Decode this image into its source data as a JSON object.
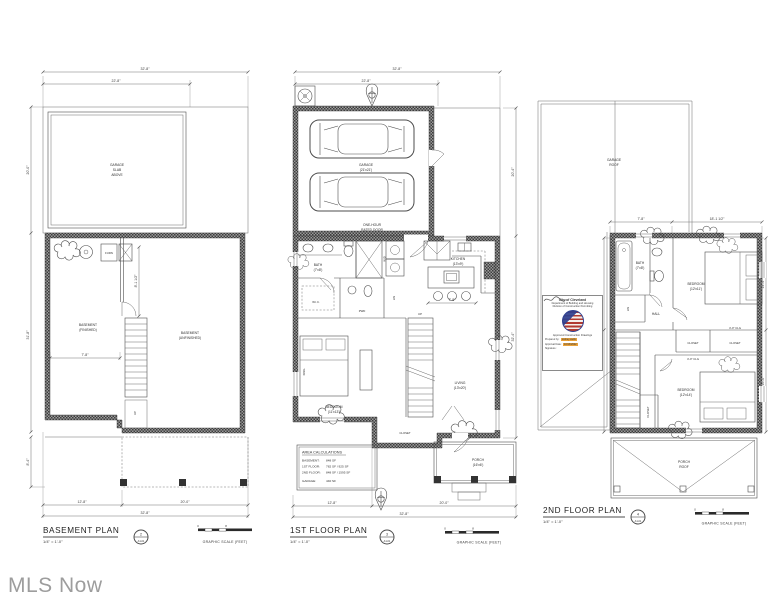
{
  "watermark": "MLS Now",
  "shared": {
    "graphic_scale": "GRAPHIC SCALE (FEET)",
    "scale_note": "1/4\" = 1'-0\"",
    "bar_zero": "0",
    "bar_eight": "8"
  },
  "basement": {
    "title": "BASEMENT PLAN",
    "ref_no": "2",
    "ref_sheet": "A1-01",
    "garage_slab": {
      "l1": "GARAGE",
      "l2": "SLAB",
      "l3": "ABOVE"
    },
    "room_left": {
      "l1": "BASEMENT",
      "l2": "(FINISHED)"
    },
    "room_right": {
      "l1": "BASEMENT",
      "l2": "(UNFINISHED)"
    },
    "furnace": "FURN",
    "stairs_up": "UP",
    "dims": {
      "top_total": "32'-8\"",
      "top_partial": "22'-8\"",
      "left_upper": "20'-0\"",
      "left_lower": "31'-8\"",
      "left_porch": "8'-4\"",
      "interior_width": "7'-8\"",
      "interior_height": "8'-1 1/2\"",
      "bottom_left": "12'-8\"",
      "bottom_right": "20'-0\"",
      "bottom_total": "32'-8\""
    }
  },
  "first": {
    "title": "1ST FLOOR PLAN",
    "ref_no": "3",
    "ref_sheet": "A1-01",
    "garage": {
      "l1": "GARAGE",
      "l2": "(21'x21')"
    },
    "rated_door": {
      "l1": "ONE-HOUR",
      "l2": "RATED DOOR"
    },
    "bath": {
      "l1": "BATH",
      "l2": "(7'x8')"
    },
    "wd": "W/D",
    "wic": "W.I.C.",
    "pwd": "PWD",
    "linen": "LIN",
    "kitchen": {
      "l1": "KITCHEN",
      "l2": "(13'x9')"
    },
    "living": {
      "l1": "LIVING",
      "l2": "(13'x20')"
    },
    "bedroom": {
      "l1": "BEDROOM",
      "l2": "(11'x13')"
    },
    "king": "KING",
    "closet": "CLOSET",
    "porch": {
      "l1": "PORCH",
      "l2": "(16'x6')"
    },
    "stairs_up": "UP",
    "area_calc": {
      "title": "AREA CALCULATIONS",
      "rows": [
        {
          "label": "BASEMENT:",
          "value": "848 SF"
        },
        {
          "label": "1ST FLOOR:",
          "value": "782 SF / 925 SF"
        },
        {
          "label": "2ND FLOOR:",
          "value": "848 SF / 1595 SF"
        },
        {
          "label": "GARAGE:",
          "value": "440 SF"
        }
      ]
    },
    "dims": {
      "top_total": "32'-8\"",
      "top_partial": "22'-8\"",
      "right_garage": "20'-4\"",
      "right_house": "32'-4\"",
      "kitchen_island": "7'-8\"",
      "bottom_left": "12'-8\"",
      "bottom_right": "20'-0\"",
      "bottom_total": "32'-8\""
    }
  },
  "second": {
    "title": "2ND FLOOR PLAN",
    "ref_no": "4",
    "ref_sheet": "A1-01",
    "garage_roof": {
      "l1": "GARAGE",
      "l2": "ROOF"
    },
    "bath": {
      "l1": "BATH",
      "l2": "(7'x8')"
    },
    "linen": "LIN",
    "hall": "HALL",
    "bedroom1": {
      "l1": "BEDROOM",
      "l2": "(12'x11')"
    },
    "bedroom2": {
      "l1": "BEDROOM",
      "l2": "(12'x14')"
    },
    "closet1": "CLOSET",
    "closet2": "CLOSET",
    "closet3": "CLOSET",
    "clg_note1": "4'-0\" CLG",
    "clg_note2": "4'-0\" CLG",
    "porch_roof": {
      "l1": "PORCH",
      "l2": "ROOF"
    },
    "dims": {
      "top_left": "7'-8\"",
      "top_right": "18'-1 1/2\"",
      "right_upper": "14'-4\"",
      "right_lower": "16'-0\""
    },
    "stamp": {
      "line1": "City of Cleveland",
      "line2": "Department of Building and Housing",
      "line3": "Division of Construction Permitting",
      "approved": "Approved Construction Drawings",
      "prepared_label": "Prepared by:",
      "prepared_value": "rodney wells",
      "date_label": "Approval Date:",
      "date_value": "10/13/2022",
      "signature_label": "Signature:"
    }
  }
}
